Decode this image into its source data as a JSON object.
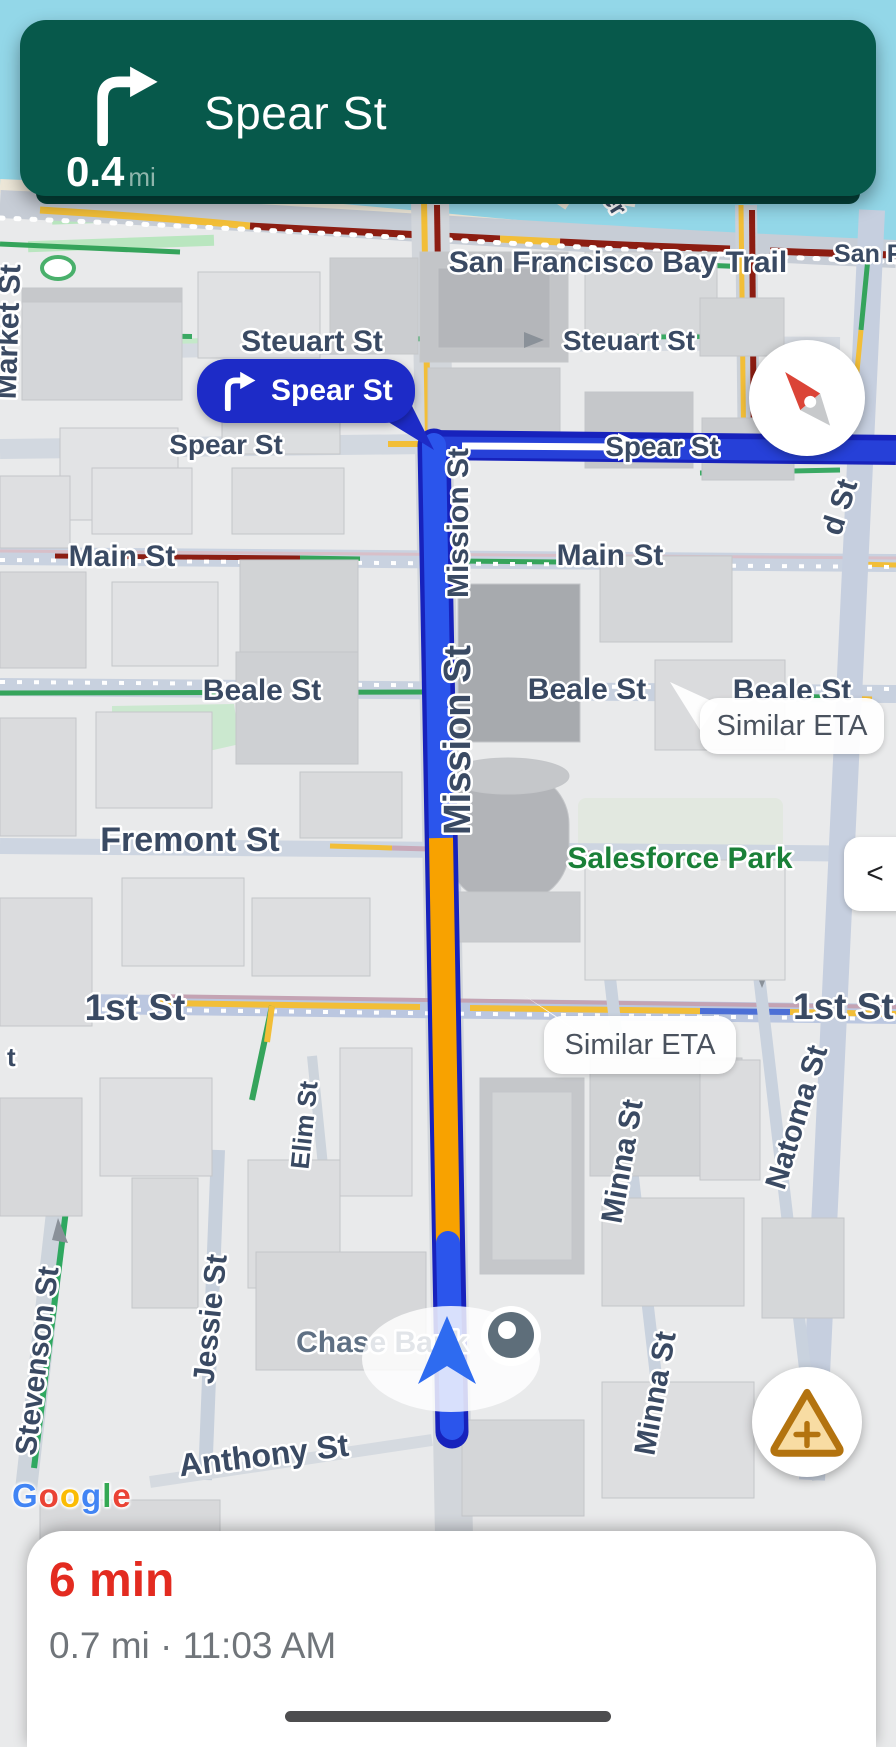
{
  "banner": {
    "instruction": "Spear St",
    "distance_value": "0.4",
    "distance_unit": "mi"
  },
  "callout": {
    "label": "Spear St"
  },
  "eta_bubbles": {
    "first": "Similar ETA",
    "second": "Similar ETA"
  },
  "controls": {
    "collapse_label": "<"
  },
  "footer": {
    "duration": "6 min",
    "details": "0.7 mi · 11:03 AM"
  },
  "map": {
    "labels": [
      {
        "text": "San Francisco Bay Trail"
      },
      {
        "text": "San Fran"
      },
      {
        "text": "Pier"
      },
      {
        "text": "Market St"
      },
      {
        "text": "Steuart St"
      },
      {
        "text": "Steuart St"
      },
      {
        "text": "Spear St"
      },
      {
        "text": "Spear St"
      },
      {
        "text": "Main St"
      },
      {
        "text": "Main St"
      },
      {
        "text": "Beale St"
      },
      {
        "text": "Beale St"
      },
      {
        "text": "Beale St"
      },
      {
        "text": "Fremont St"
      },
      {
        "text": "Salesforce Park"
      },
      {
        "text": "1st St"
      },
      {
        "text": "1st St"
      },
      {
        "text": "Mission St"
      },
      {
        "text": "Mission St"
      },
      {
        "text": "Natoma St"
      },
      {
        "text": "Minna St"
      },
      {
        "text": "Minna St"
      },
      {
        "text": "Elim St"
      },
      {
        "text": "Jessie St"
      },
      {
        "text": "Stevenson St"
      },
      {
        "text": "Anthony St"
      },
      {
        "text": "Chase Bank"
      },
      {
        "text": "d St"
      },
      {
        "text": "t"
      }
    ]
  },
  "google": {
    "letters": [
      {
        "ch": "G",
        "color": "#4285F4"
      },
      {
        "ch": "o",
        "color": "#EA4335"
      },
      {
        "ch": "o",
        "color": "#FBBC05"
      },
      {
        "ch": "g",
        "color": "#4285F4"
      },
      {
        "ch": "l",
        "color": "#34A853"
      },
      {
        "ch": "e",
        "color": "#EA4335"
      }
    ]
  },
  "icons": {
    "turn_right_icon": "right-turn arrow",
    "compass_icon": "compass needle",
    "report_icon": "warning triangle with plus",
    "location_puck_icon": "navigation chevron",
    "camera_icon": "dark circle with dot"
  },
  "colors": {
    "banner_green": "#07594B",
    "callout_blue": "#1D2BC7",
    "route_blue": "#2B55EC",
    "route_after_turn_blue": "#2640D8",
    "route_casing": "#1722BC",
    "traffic_orange": "#F8A200",
    "traffic_dark_red": "#8C1D12",
    "traffic_yellow": "#F2BE38",
    "duration_red": "#E32B20",
    "water": "#93D7E8",
    "park_green": "#B9E6BF"
  }
}
